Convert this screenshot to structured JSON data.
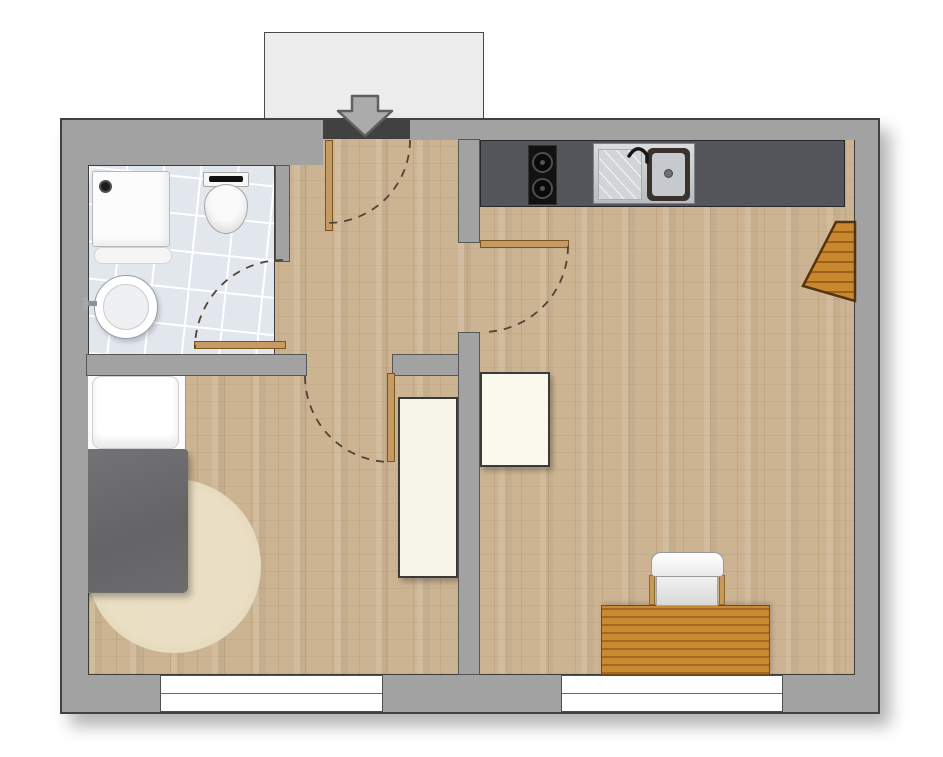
{
  "page": {
    "title": "apartment-floor-plan",
    "visible_text": ""
  },
  "colors": {
    "wall": "#a2a2a2",
    "wall_outline": "#414141",
    "floor_wood": "#ccb493",
    "bath_tile": "#e2e6ed",
    "counter": "#55565b",
    "door_leaf": "#c69a63",
    "swing_arc": "#4f4336",
    "rug": "#e7dcc0",
    "blanket": "#6b6b6d",
    "desk_wood": "#ca8a31",
    "wall_table_wood": "#c9882e",
    "vestibule": "#ededed",
    "window": "#ffffff",
    "entry_arrow": "#ababab"
  },
  "rooms": [
    {
      "id": "bathroom",
      "fixtures": [
        "shower-tray",
        "floor-drain",
        "bath-mat",
        "toilet",
        "washbasin",
        "tiled-floor"
      ]
    },
    {
      "id": "hallway",
      "fixtures": [
        "entry-door"
      ]
    },
    {
      "id": "bedroom",
      "fixtures": [
        "single-bed",
        "pillow",
        "blanket",
        "round-rug",
        "wardrobe",
        "window"
      ]
    },
    {
      "id": "living-kitchen",
      "fixtures": [
        "kitchen-counter",
        "two-burner-cooktop",
        "kitchen-sink",
        "wall-mounted-table",
        "cabinet",
        "desk",
        "chair",
        "window"
      ]
    }
  ],
  "doors": [
    {
      "id": "entry-door",
      "swing": "into-hallway"
    },
    {
      "id": "bathroom-door",
      "swing": "into-bathroom"
    },
    {
      "id": "bedroom-door",
      "swing": "into-bedroom"
    },
    {
      "id": "kitchen-door",
      "swing": "into-living-room"
    }
  ],
  "windows": [
    {
      "id": "bedroom-window",
      "wall": "south"
    },
    {
      "id": "living-room-window",
      "wall": "south"
    }
  ],
  "entrance": {
    "symbol": "down-arrow"
  }
}
